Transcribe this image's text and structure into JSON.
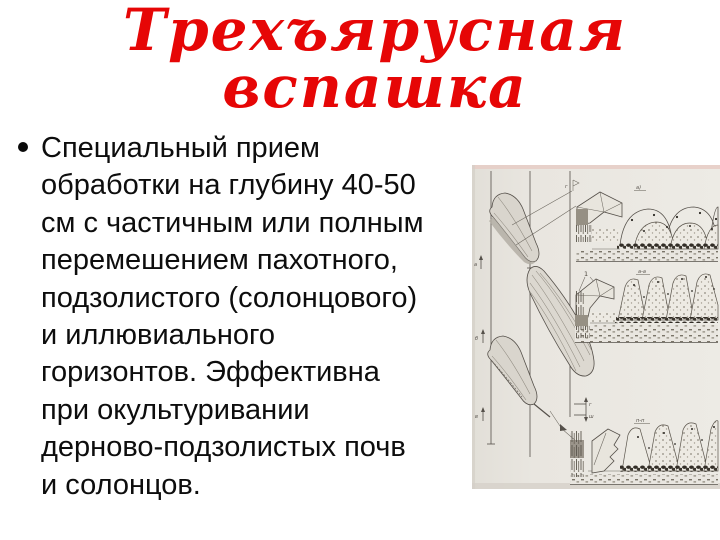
{
  "slide": {
    "title": "Трехъярусная\nвспашка",
    "title_color": "#e60606",
    "bullet_text": "Специальный прием\nобработки на глубину 40-50\nсм с частичным или полным\nперемешением пахотного,\nподзолистого (солонцового)\nи иллювиального\nгоризонтов. Эффективна\nпри окультуривании\nдерново-подзолистых почв\nи солонцов."
  },
  "figure": {
    "name": "three-tier-plowing-scanned-diagram",
    "paper_color": "#e9e6e0",
    "ink_color": "#55504a",
    "labels": {
      "pointer": "1",
      "section_top": "а)",
      "section_mid": "а-а",
      "section_bottom": "п-п",
      "tick1": "а",
      "tick2": "б",
      "tick3": "в",
      "bracket_upper": "г",
      "bracket_lower": "ш",
      "flag": "г"
    }
  }
}
